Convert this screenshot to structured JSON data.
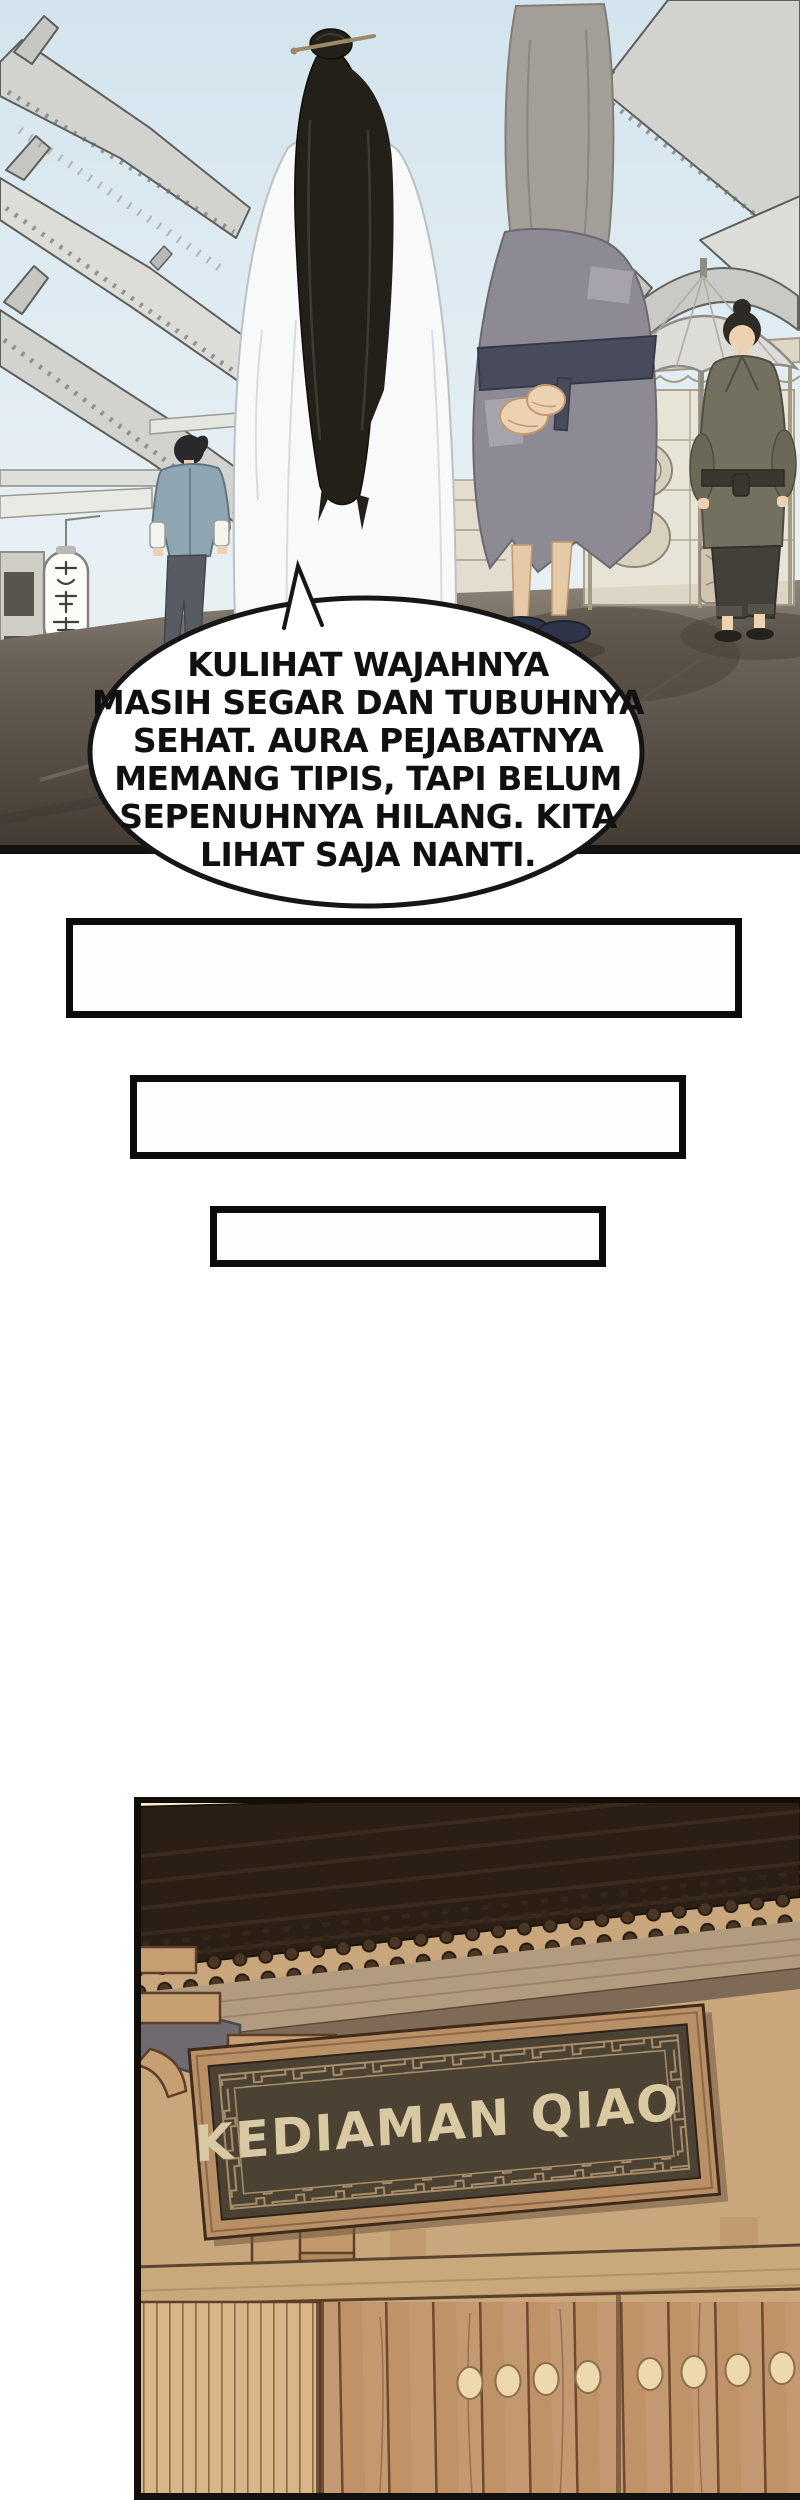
{
  "comic": {
    "speech_bubble": {
      "lines": [
        "KULIHAT WAJAHNYA",
        "MASIH SEGAR DAN TUBUHNYA",
        "SEHAT. AURA PEJABATNYA",
        "MEMANG TIPIS, TAPI BELUM",
        "SEPENUHNYA HILANG. KITA",
        "LIHAT SAJA NANTI."
      ]
    },
    "gate_sign": {
      "text": "KEDIAMAN QIAO"
    },
    "street_lantern_sign": {
      "text": "庆丰楼"
    },
    "empty_boxes_count": "3"
  },
  "colors": {
    "sky": "#dce9f0",
    "road": "#6a6159",
    "bubble_outline": "#161616",
    "box_border": "#0c0c0c",
    "roof_dark": "#2b1f15",
    "door_wood": "#c09268",
    "sign_board": "#4c4234",
    "sign_text": "#d9c9a2"
  }
}
